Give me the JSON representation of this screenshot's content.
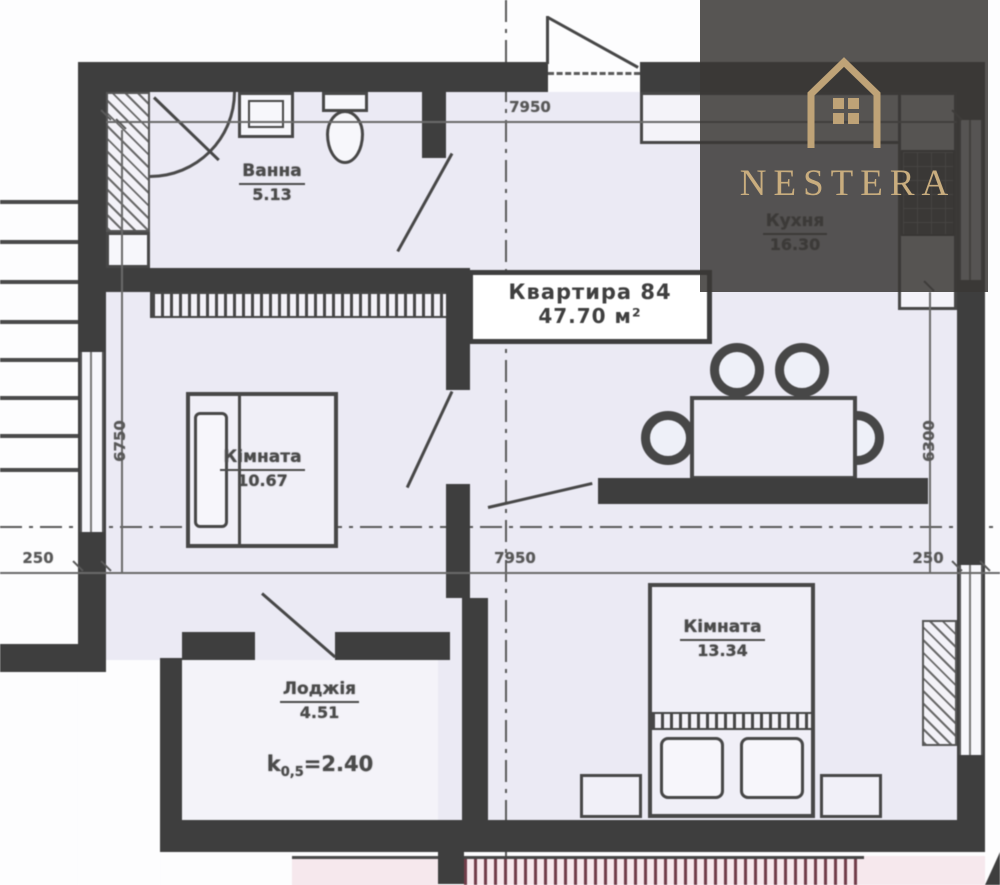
{
  "brand": {
    "name": "NESTERA",
    "icon": "house-outline-icon"
  },
  "apartment": {
    "title": "Квартира 84",
    "area": "47.70 м²"
  },
  "rooms": [
    {
      "id": "bathroom",
      "name": "Ванна",
      "area": "5.13"
    },
    {
      "id": "kitchen",
      "name": "Кухня",
      "area": "16.30"
    },
    {
      "id": "bedroom-left",
      "name": "Кімната",
      "area": "10.67"
    },
    {
      "id": "bedroom-right",
      "name": "Кімната",
      "area": "13.34"
    },
    {
      "id": "loggia",
      "name": "Лоджія",
      "area": "4.51",
      "coef_k": "k",
      "coef_sub": "0,5",
      "coef_val": "=2.40"
    }
  ],
  "dimensions": {
    "top": "7950",
    "middle": "7950",
    "left_offset": "250",
    "right_offset": "250",
    "left_height": "6750",
    "right_height": "6300"
  },
  "colors": {
    "wall": "#3e3e3e",
    "room_fill": "#ebeaf4",
    "accent_gold": "#c9ad7e",
    "overlay_gray": "#393735",
    "pink": "#f6e8ed",
    "railing_red": "#713d49"
  }
}
